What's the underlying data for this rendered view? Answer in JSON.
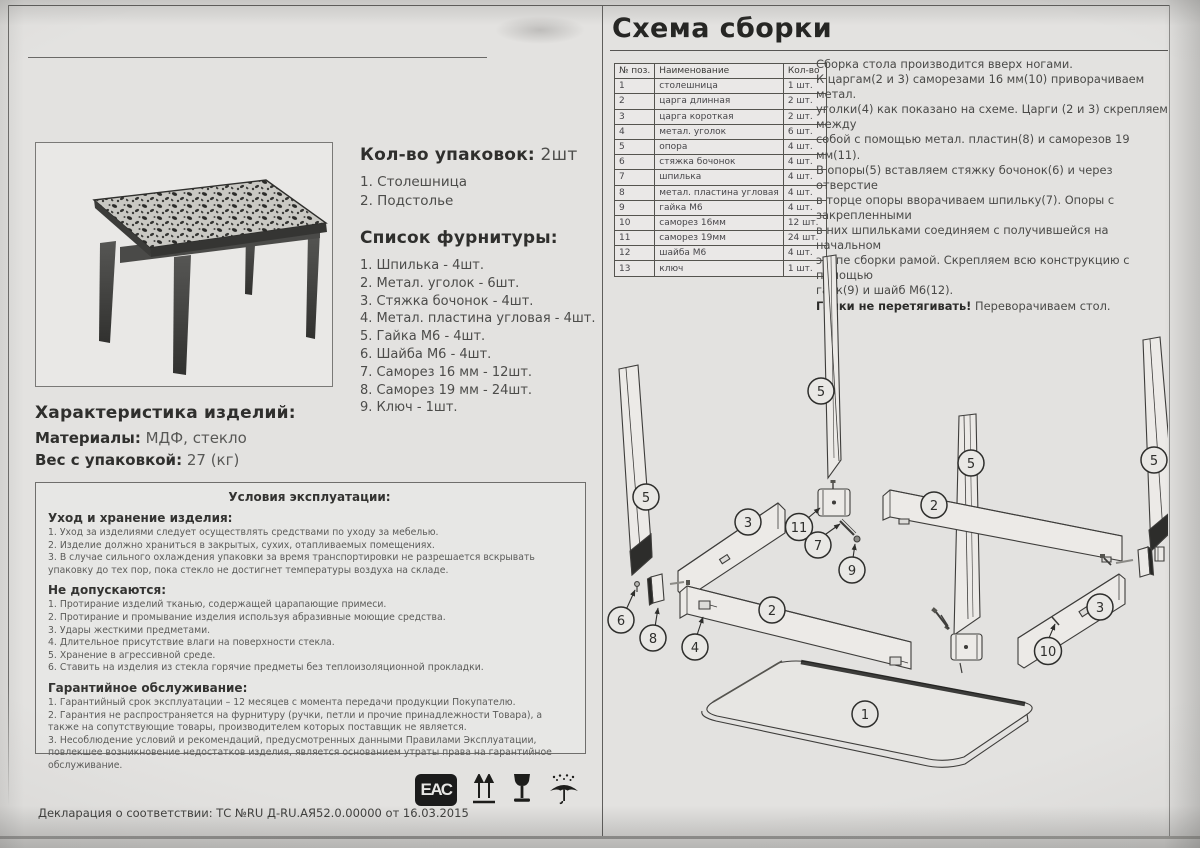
{
  "left": {
    "packages": {
      "label": "Кол-во упаковок:",
      "value": " 2шт",
      "items": [
        "1. Столешница",
        "2. Подстолье"
      ]
    },
    "hardware": {
      "title": "Список фурнитуры:",
      "items": [
        "1. Шпилька - 4шт.",
        "2. Метал. уголок - 6шт.",
        "3. Стяжка бочонок - 4шт.",
        "4. Метал. пластина угловая - 4шт.",
        "5. Гайка М6 - 4шт.",
        "6. Шайба М6 - 4шт.",
        "7. Саморез 16 мм - 12шт.",
        "8. Саморез 19 мм - 24шт.",
        "9. Ключ - 1шт."
      ]
    },
    "characteristics": {
      "title": "Характеристика изделий:",
      "materials_label": "Материалы:",
      "materials_value": " МДФ, стекло",
      "weight_label": "Вес с упаковкой:",
      "weight_value": " 27 (кг)"
    },
    "conditions": {
      "title": "Условия эксплуатации:",
      "care": {
        "heading": "Уход и хранение изделия:",
        "items": [
          "1. Уход за изделиями следует осуществлять средствами по уходу за мебелью.",
          "2. Изделие должно храниться в закрытых, сухих, отапливаемых помещениях.",
          "3. В случае сильного охлаждения упаковки за время транспортировки не разрешается вскрывать упаковку до тех пор, пока стекло не достигнет температуры воздуха на складе."
        ]
      },
      "prohibited": {
        "heading": "Не допускаются:",
        "items": [
          "1. Протирание изделий тканью, содержащей царапающие примеси.",
          "2. Протирание и промывание изделия используя абразивные моющие средства.",
          "3. Удары жесткими предметами.",
          "4. Длительное присутствие влаги на поверхности стекла.",
          "5. Хранение в агрессивной среде.",
          "6. Ставить на изделия из стекла горячие предметы без теплоизоляционной прокладки."
        ]
      },
      "warranty": {
        "heading": "Гарантийное обслуживание:",
        "items": [
          "1. Гарантийный срок эксплуатации – 12 месяцев с момента передачи продукции Покупателю.",
          "2. Гарантия не распространяется на фурнитуру (ручки, петли и прочие принадлежности Товара), а также на сопутствующие товары, производителем которых поставщик не является.",
          "3. Несоблюдение условий и рекомендаций, предусмотренных данными Правилами Эксплуатации, повлекшее возникновение недостатков изделия, является основанием утраты права на гарантийное обслуживание."
        ]
      }
    },
    "declaration": "Декларация о соответствии: ТС №RU Д-RU.АЯ52.0.00000 от 16.03.2015",
    "eac_label": "ЕАС"
  },
  "right": {
    "title": "Схема сборки",
    "parts_table": {
      "headers": [
        "№ поз.",
        "Наименование",
        "Кол-во"
      ],
      "rows": [
        [
          "1",
          "столешница",
          "1 шт."
        ],
        [
          "2",
          "царга длинная",
          "2 шт."
        ],
        [
          "3",
          "царга короткая",
          "2 шт."
        ],
        [
          "4",
          "метал. уголок",
          "6 шт."
        ],
        [
          "5",
          "опора",
          "4 шт."
        ],
        [
          "6",
          "стяжка бочонок",
          "4 шт."
        ],
        [
          "7",
          "шпилька",
          "4 шт."
        ],
        [
          "8",
          "метал. пластина угловая",
          "4 шт."
        ],
        [
          "9",
          "гайка М6",
          "4 шт."
        ],
        [
          "10",
          "саморез 16мм",
          "12 шт."
        ],
        [
          "11",
          "саморез 19мм",
          "24 шт."
        ],
        [
          "12",
          "шайба М6",
          "4 шт."
        ],
        [
          "13",
          "ключ",
          "1 шт."
        ]
      ]
    },
    "instructions": {
      "body": "Сборка стола производится вверх ногами.\nК царгам(2 и 3) саморезами 16 мм(10) приворачиваем метал.\nуголки(4) как показано на схеме. Царги (2 и 3) скрепляем между\nсобой с помощью метал. пластин(8) и саморезов 19 мм(11).\nВ опоры(5) вставляем стяжку бочонок(6) и через отверстие\nв торце опоры вворачиваем шпильку(7). Опоры с закрепленными\nв них шпильками соединяем с получившейся на начальном\nэтапе сборки рамой. Скрепляем всю конструкцию с помощью\nгаек(9) и шайб М6(12).",
      "warning_bold": "Гайки не перетягивать!",
      "warning_rest": " Переворачиваем стол."
    },
    "diagram": {
      "callouts": [
        "5",
        "5",
        "5",
        "5",
        "3",
        "2",
        "11",
        "7",
        "9",
        "6",
        "8",
        "4",
        "2",
        "10",
        "3",
        "1"
      ]
    }
  }
}
